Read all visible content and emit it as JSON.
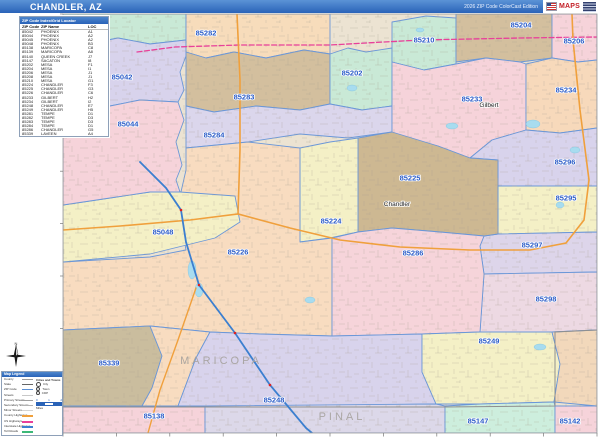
{
  "header": {
    "title": "CHANDLER, AZ",
    "edition": "2026 ZIP Code ColorCast Edition",
    "logo_text": "MAPS"
  },
  "index_table": {
    "title": "ZIP Code Index/Grid Locator",
    "columns": [
      "ZIP Code",
      "ZIP Name",
      "LOC"
    ],
    "rows": [
      [
        "85042",
        "PHOENIX",
        "A1"
      ],
      [
        "85044",
        "PHOENIX",
        "A2"
      ],
      [
        "85045",
        "PHOENIX",
        "A2"
      ],
      [
        "85048",
        "PHOENIX",
        "B3"
      ],
      [
        "85138",
        "MARICOPA",
        "C8"
      ],
      [
        "85139",
        "MARICOPA",
        "A8"
      ],
      [
        "85140",
        "QUEEN CREEK",
        "J7"
      ],
      [
        "85147",
        "SACATON",
        "I8"
      ],
      [
        "85202",
        "MESA",
        "F1"
      ],
      [
        "85204",
        "MESA",
        "I1"
      ],
      [
        "85206",
        "MESA",
        "J1"
      ],
      [
        "85208",
        "MESA",
        "J1"
      ],
      [
        "85210",
        "MESA",
        "G1"
      ],
      [
        "85224",
        "CHANDLER",
        "F3"
      ],
      [
        "85225",
        "CHANDLER",
        "G3"
      ],
      [
        "85226",
        "CHANDLER",
        "C6"
      ],
      [
        "85233",
        "GILBERT",
        "H2"
      ],
      [
        "85234",
        "GILBERT",
        "I2"
      ],
      [
        "85248",
        "CHANDLER",
        "E7"
      ],
      [
        "85249",
        "CHANDLER",
        "H5"
      ],
      [
        "85281",
        "TEMPE",
        "D1"
      ],
      [
        "85282",
        "TEMPE",
        "D3"
      ],
      [
        "85283",
        "TEMPE",
        "D3"
      ],
      [
        "85284",
        "TEMPE",
        "D1"
      ],
      [
        "85286",
        "CHANDLER",
        "G5"
      ],
      [
        "85339",
        "LAVEEN",
        "A4"
      ]
    ]
  },
  "legend": {
    "title": "Map Legend",
    "items": [
      {
        "label": "County",
        "color": "#9a9a9a",
        "w": 1,
        "dash": false
      },
      {
        "label": "State",
        "color": "#666666",
        "w": 1.5,
        "dash": false
      },
      {
        "label": "ZIP Code",
        "color": "#5b8fd4",
        "w": 1.5,
        "dash": false
      },
      {
        "label": "Streets",
        "color": "#c8c8c8",
        "w": 1,
        "dash": false
      },
      {
        "label": "Primary Streets",
        "color": "#9f9f9f",
        "w": 1.5,
        "dash": false
      },
      {
        "label": "Secondary Streets",
        "color": "#b4b4b4",
        "w": 1,
        "dash": false
      },
      {
        "label": "Minor Streets",
        "color": "#d4d4d4",
        "w": 1,
        "dash": false
      },
      {
        "label": "County Highways",
        "color": "#f0a03c",
        "w": 2,
        "dash": false
      },
      {
        "label": "US Highways",
        "color": "#e8409a",
        "w": 2,
        "dash": true
      },
      {
        "label": "Interstate Highways",
        "color": "#3b7fd0",
        "w": 2,
        "dash": false
      },
      {
        "label": "Toll Roads",
        "color": "#3cb878",
        "w": 2,
        "dash": false
      }
    ],
    "cities_title": "Cities and Towns",
    "city_classes": [
      {
        "label": "City",
        "size": 3
      },
      {
        "label": "Town",
        "size": 2.4
      },
      {
        "label": "CDP",
        "size": 1.8
      }
    ],
    "scale_label": "Miles",
    "scale_ticks": [
      "0",
      "1",
      "2"
    ]
  },
  "compass": {
    "north_label": "N"
  },
  "map": {
    "bg_color": "#ece3d2",
    "boundary_color": "#6b97d8",
    "regions": [
      {
        "id": "corner-nw",
        "color": "#c9e9d6",
        "points": "63,14 186,14 186,40 150,44 118,38 88,44 63,40",
        "label": "",
        "lx": 0,
        "ly": 0
      },
      {
        "id": "85042",
        "color": "#d8d3ec",
        "points": "63,40 88,44 118,38 150,44 186,40 186,56 180,72 184,90 178,102 140,100 110,106 80,99 63,103",
        "label": "85042",
        "lx": 122,
        "ly": 77
      },
      {
        "id": "85282",
        "color": "#f7dcbb",
        "points": "186,14 330,14 330,54 304,50 266,58 234,52 206,58 186,52",
        "label": "85282",
        "lx": 206,
        "ly": 33
      },
      {
        "id": "85283",
        "color": "#d3bf9e",
        "points": "186,52 206,58 234,52 266,58 304,50 330,54 330,104 300,110 256,106 214,112 186,106",
        "label": "85283",
        "lx": 244,
        "ly": 97
      },
      {
        "id": "85202",
        "color": "#c9e9d6",
        "points": "330,54 348,48 366,52 392,48 392,106 362,110 330,104",
        "label": "85202",
        "lx": 352,
        "ly": 73
      },
      {
        "id": "85210",
        "color": "#c9e9d6",
        "points": "392,22 426,16 456,18 456,64 424,70 392,62",
        "label": "85210",
        "lx": 424,
        "ly": 40
      },
      {
        "id": "85204",
        "color": "#d3bf9e",
        "points": "456,14 552,14 552,58 520,62 486,58 456,62",
        "label": "85204",
        "lx": 521,
        "ly": 25
      },
      {
        "id": "85206",
        "color": "#f6d3da",
        "points": "552,14 597,14 597,60 578,62 552,58",
        "label": "85206",
        "lx": 574,
        "ly": 41
      },
      {
        "id": "85284",
        "color": "#dbd6ec",
        "points": "186,106 214,112 256,106 300,110 330,104 362,110 392,106 392,132 348,138 300,134 248,142 186,148",
        "label": "85284",
        "lx": 214,
        "ly": 135
      },
      {
        "id": "85233",
        "color": "#f6d3da",
        "points": "392,62 424,70 456,64 486,58 520,62 526,64 526,130 492,140 470,158 438,146 392,134",
        "label": "85233",
        "lx": 472,
        "ly": 99
      },
      {
        "id": "85234",
        "color": "#f7d9bb",
        "points": "526,64 552,58 578,62 597,60 597,128 560,133 526,130",
        "label": "85234",
        "lx": 566,
        "ly": 90
      },
      {
        "id": "85296",
        "color": "#d8d3ec",
        "points": "492,140 526,130 560,133 597,128 597,186 498,186 498,160 470,158",
        "label": "85296",
        "lx": 565,
        "ly": 162
      },
      {
        "id": "85295",
        "color": "#f4f0c6",
        "points": "498,186 597,186 597,232 498,234",
        "label": "85295",
        "lx": 566,
        "ly": 198
      },
      {
        "id": "85297",
        "color": "#ddd5ea",
        "points": "498,234 597,232 597,272 484,274 480,246 484,236",
        "label": "85297",
        "lx": 532,
        "ly": 245
      },
      {
        "id": "85298",
        "color": "#edd9e3",
        "points": "484,274 597,272 597,330 552,332 480,332",
        "label": "85298",
        "lx": 546,
        "ly": 299
      },
      {
        "id": "85225",
        "color": "#cdb892",
        "points": "358,138 392,132 438,146 470,158 498,160 498,234 484,236 440,232 392,228 358,232",
        "label": "85225",
        "lx": 410,
        "ly": 178
      },
      {
        "id": "85224",
        "color": "#f4f0c6",
        "points": "300,148 330,142 358,138 358,232 330,238 300,242",
        "label": "85224",
        "lx": 331,
        "ly": 221
      },
      {
        "id": "85226",
        "color": "#f8dcc0",
        "points": "186,148 248,142 300,148 300,242 332,238 332,336 260,334 210,332 150,326 63,330 63,262 150,257 186,250 178,205 186,170",
        "label": "85226",
        "lx": 238,
        "ly": 252
      },
      {
        "id": "85286",
        "color": "#f6d4da",
        "points": "332,238 358,232 392,228 440,232 484,236 480,246 484,274 480,332 422,334 332,336",
        "label": "85286",
        "lx": 413,
        "ly": 253
      },
      {
        "id": "85048",
        "color": "#f4f0c6",
        "points": "63,205 110,198 150,192 180,192 235,196 240,222 215,238 150,254 63,262",
        "label": "85048",
        "lx": 163,
        "ly": 232
      },
      {
        "id": "85044",
        "color": "#f6d3da",
        "points": "63,103 80,99 110,106 140,100 178,102 184,120 176,142 182,165 176,180 180,192 150,192 110,198 63,205",
        "label": "85044",
        "lx": 128,
        "ly": 124
      },
      {
        "id": "85339",
        "color": "#cabd9e",
        "points": "63,330 150,326 162,356 152,388 142,406 63,406",
        "label": "85339",
        "lx": 109,
        "ly": 363
      },
      {
        "id": "corridor-s",
        "color": "#f8dcc0",
        "points": "150,326 210,332 196,358 178,406 142,406 152,388 162,356",
        "label": "",
        "lx": 0,
        "ly": 0
      },
      {
        "id": "85248",
        "color": "#d8d3ec",
        "points": "210,332 260,334 332,336 422,334 422,372 436,404 300,406 178,406 196,358",
        "label": "85248",
        "lx": 274,
        "ly": 400
      },
      {
        "id": "85249",
        "color": "#f4f0c6",
        "points": "422,334 480,332 552,332 560,364 554,402 480,404 436,404 422,372",
        "label": "85249",
        "lx": 489,
        "ly": 341
      },
      {
        "id": "corner-se",
        "color": "#f2d8bb",
        "points": "552,332 597,330 597,406 554,402 560,364",
        "label": "",
        "lx": 0,
        "ly": 0
      },
      {
        "id": "85138",
        "color": "#f6d3da",
        "points": "63,406 205,406 205,433 63,433",
        "label": "85138",
        "lx": 154,
        "ly": 416
      },
      {
        "id": "strip-pinal",
        "color": "#dcd8e9",
        "points": "205,406 436,404 445,406 445,433 205,433",
        "label": "",
        "lx": 0,
        "ly": 0
      },
      {
        "id": "85147",
        "color": "#cdeedd",
        "points": "445,406 480,404 554,402 555,406 555,433 445,433",
        "label": "85147",
        "lx": 478,
        "ly": 421
      },
      {
        "id": "85142",
        "color": "#f6d3da",
        "points": "555,406 597,406 597,433 555,433",
        "label": "85142",
        "lx": 570,
        "ly": 421
      }
    ],
    "roads": [
      {
        "id": "us-60",
        "color": "#e8409a",
        "w": 1.3,
        "dash": "5,2.5",
        "points": "137,52 175,47 240,45 330,45 420,40 520,38 597,37"
      },
      {
        "id": "loop-101",
        "color": "#f0a03c",
        "w": 1.6,
        "dash": "",
        "points": "237,14 240,80 240,150 238,214"
      },
      {
        "id": "loop-202",
        "color": "#f0a03c",
        "w": 1.6,
        "dash": "",
        "points": "63,230 120,226 190,220 238,214 290,228 340,240 400,247 470,250 530,250 566,243 584,220 589,180 580,110 573,40 572,14"
      },
      {
        "id": "az-347",
        "color": "#f0a03c",
        "w": 1.4,
        "dash": "",
        "points": "196,288 178,340 160,390 148,433"
      },
      {
        "id": "i-10",
        "color": "#3b7fd0",
        "w": 1.8,
        "dash": "",
        "points": "140,162 166,188 181,210 186,242 199,285 235,333 270,385 306,428 312,433"
      }
    ],
    "interchanges": [
      [
        181,
        210
      ],
      [
        199,
        285
      ],
      [
        235,
        333
      ],
      [
        270,
        385
      ]
    ],
    "county_line": "63,407 205,407 445,407 555,406 555,332 597,330",
    "waters": [
      [
        352,
        88,
        5,
        3
      ],
      [
        452,
        126,
        6,
        3
      ],
      [
        533,
        124,
        7,
        4
      ],
      [
        560,
        205,
        4,
        3
      ],
      [
        192,
        270,
        4,
        9
      ],
      [
        199,
        290,
        4,
        7
      ],
      [
        540,
        347,
        6,
        3
      ],
      [
        420,
        30,
        4,
        2
      ],
      [
        310,
        300,
        5,
        3
      ],
      [
        575,
        150,
        5,
        3
      ]
    ],
    "cities": [
      {
        "name": "Gilbert",
        "x": 489,
        "y": 107
      },
      {
        "name": "Chandler",
        "x": 397,
        "y": 206
      }
    ],
    "counties": [
      {
        "name": "MARICOPA",
        "x": 221,
        "y": 364
      },
      {
        "name": "PINAL",
        "x": 342,
        "y": 420
      }
    ]
  }
}
